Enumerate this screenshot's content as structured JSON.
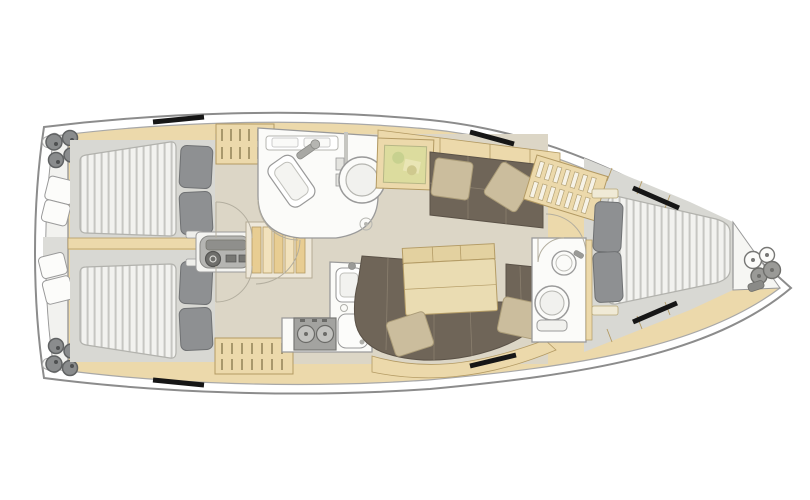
{
  "diagram": {
    "type": "yacht-interior-floor-plan",
    "description": "Top-down interior layout plan of a sailing yacht, bow pointing right",
    "orientation": {
      "bow": "right",
      "stern": "left"
    }
  },
  "palette": {
    "hullStroke": "#8c8c8c",
    "deckLine": "#a8a8a8",
    "wood": "#ecd9ab",
    "woodStroke": "#b39a63",
    "floorMain": "#dcd6c6",
    "floorCabin": "#d8d8d3",
    "headFloor": "#fbfbf9",
    "wallStroke": "#9a9a9a",
    "mattress": "#f2f2ef",
    "mattressStripe": "#c6c6c2",
    "mattressEdge": "#b2b2ad",
    "pillow": "#8e9092",
    "pillowStroke": "#6f7173",
    "settee": "#6f6558",
    "setteeLine": "#8a7f6e",
    "setteePillow": "#cbbd9d",
    "setteePillowStroke": "#ab9c78",
    "table": "#eadcb2",
    "tableStroke": "#b49c66",
    "hatch": "#161616",
    "metal": "#9a9a97",
    "metalDark": "#6e6e6b",
    "mapBase": "#dcdc9e",
    "mapStroke": "#b6b686",
    "arc": "#b3ae9f",
    "transom": "#f2f2ef",
    "counter": "#fbfbf8",
    "stove": "#a3a3a0",
    "burner": "#c2c2bf",
    "panel": "#b5b5b2",
    "panelDark": "#8f8f8c",
    "stairs": "#e8cd92",
    "stairsLight": "#f2e2bc",
    "white": "#ffffff"
  },
  "rooms": [
    {
      "id": "aft-cabin-port",
      "name": "Aft cabin (port)",
      "features": [
        "double berth",
        "2 pillows",
        "hanging locker"
      ]
    },
    {
      "id": "aft-cabin-starboard",
      "name": "Aft cabin (starboard)",
      "features": [
        "double berth",
        "2 pillows",
        "hanging locker"
      ]
    },
    {
      "id": "aft-head",
      "name": "Aft head / wet room",
      "features": [
        "washbasin",
        "marine toilet",
        "shower drain"
      ]
    },
    {
      "id": "galley",
      "name": "Galley",
      "features": [
        "twin-burner stove",
        "sink",
        "refrigerator"
      ]
    },
    {
      "id": "salon",
      "name": "Salon",
      "features": [
        "chart table",
        "straight settee",
        "U-shaped dinette settee",
        "folding table",
        "bottle rack"
      ]
    },
    {
      "id": "companionway",
      "name": "Companionway",
      "features": [
        "steps",
        "engine instrument panel"
      ]
    },
    {
      "id": "forward-head",
      "name": "Forward head",
      "features": [
        "round washbasin",
        "marine toilet"
      ]
    },
    {
      "id": "forward-cabin",
      "name": "Forward cabin",
      "features": [
        "V-berth",
        "2 pillows",
        "slatted locker"
      ]
    },
    {
      "id": "anchor-locker",
      "name": "Anchor locker",
      "features": [
        "windlass"
      ]
    },
    {
      "id": "transom",
      "name": "Stern / transom",
      "features": [
        "winches",
        "cockpit seats"
      ]
    }
  ],
  "deck": {
    "hatches": 6
  }
}
